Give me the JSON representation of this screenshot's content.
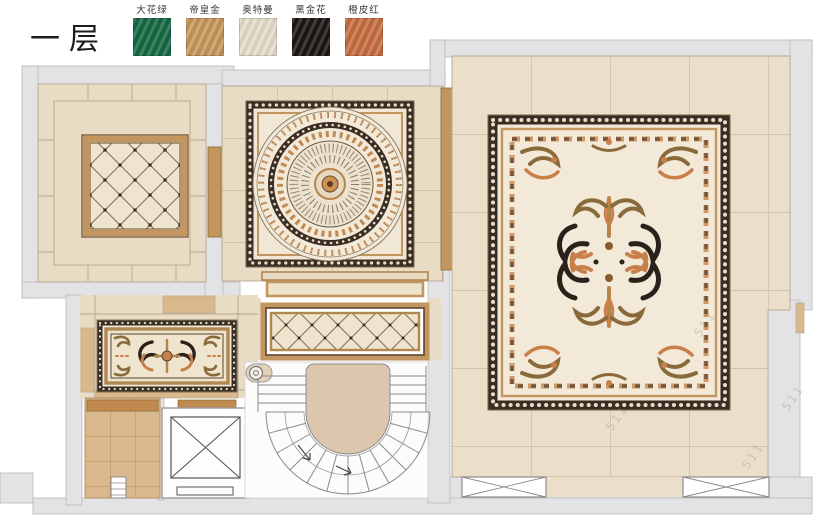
{
  "title": "一层",
  "legend": {
    "items": [
      {
        "label": "大花绿",
        "color": "#166a45"
      },
      {
        "label": "帝皇金",
        "color": "#c8975c"
      },
      {
        "label": "奥特曼",
        "color": "#e5ddca"
      },
      {
        "label": "黑金花",
        "color": "#1d1713"
      },
      {
        "label": "橙皮红",
        "color": "#c76f40"
      }
    ]
  },
  "watermark": {
    "text": "511"
  },
  "palette": {
    "wall": "#e3e3e6",
    "wallline": "#b7b7bc",
    "floor": "#e9dcc4",
    "floor2": "#ecdfc9",
    "grout": "#b7a890",
    "cream": "#f1e8d6",
    "cream2": "#ead",
    "gold": "#c2965e",
    "golddark": "#8a6a3a",
    "brown": "#5a4632",
    "dark": "#3a2d23",
    "orange": "#c97f4a",
    "black": "#2a211b",
    "tan": "#d9b98c",
    "tandark": "#c08a4f",
    "landing": "#dcc7ae",
    "line": "#8a8a8f",
    "stem": "#b5854e",
    "wm": "#8a7f72"
  }
}
